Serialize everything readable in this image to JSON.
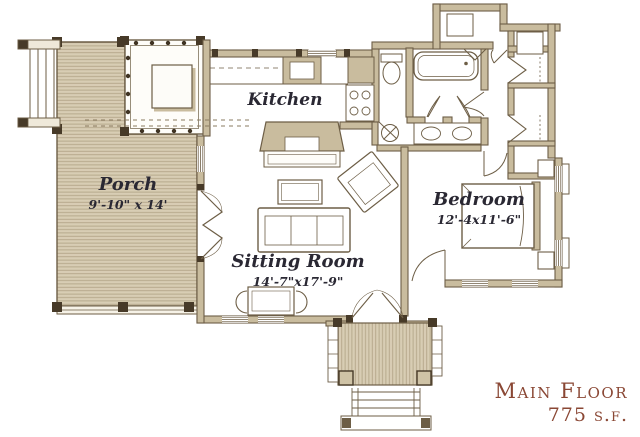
{
  "plan": {
    "rooms": {
      "kitchen": {
        "name": "Kitchen"
      },
      "porch": {
        "name": "Porch",
        "dims": "9'-10\" x 14'"
      },
      "sitting_room": {
        "name": "Sitting Room",
        "dims": "14'-7\"x17'-9\""
      },
      "bedroom": {
        "name": "Bedroom",
        "dims": "12'-4x11'-6\""
      }
    },
    "title_block": {
      "floor": "Main Floor",
      "area": "775 s.f."
    },
    "fixtures": [
      "bathtub",
      "toilet",
      "double-sink-vanity",
      "kitchen-sink",
      "range-burners",
      "refrigerator",
      "water-heater",
      "fireplace",
      "bed",
      "nightstand",
      "sofa",
      "coffee-table",
      "armchair",
      "dining-table",
      "dining-chair",
      "closet-shelf",
      "porch-steps",
      "entry-steps",
      "porch-post",
      "railing"
    ],
    "colors": {
      "paper": "#ffffff",
      "wall_fill": "#c9bc9e",
      "ink": "#6d5e46",
      "porch_fill": "#d8cdb4",
      "porch_line": "#b3a588",
      "post": "#473a28",
      "label_text": "#2a2833",
      "title_text": "#8a4734"
    }
  }
}
